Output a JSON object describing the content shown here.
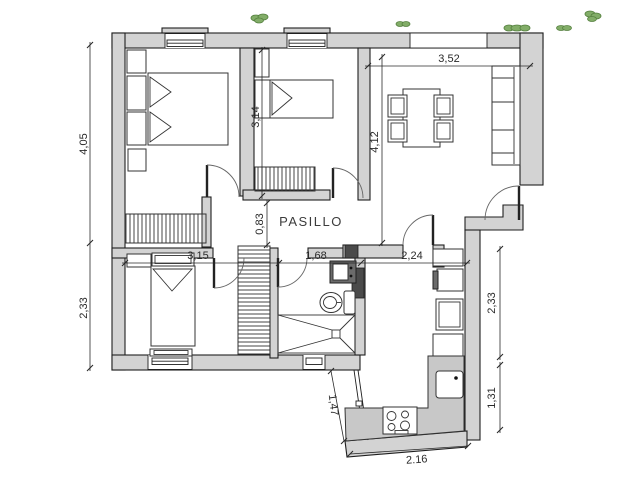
{
  "plan": {
    "hallway_label": "PASILLO",
    "dims": {
      "left_height_top": "4,05",
      "left_height_bottom": "2,33",
      "top_width_living": "3,52",
      "bedroom2_height": "3,14",
      "living_height": "4,12",
      "hallway_width": "0,83",
      "bedroom3_width": "3,15",
      "bathroom_width": "1,68",
      "kitchen_width": "2,24",
      "kitchen_right_upper": "2,33",
      "kitchen_right_lower": "1,31",
      "kitchen_glazing": "1,47",
      "kitchen_bottom": "2.16"
    },
    "colors": {
      "background": "#ffffff",
      "wall": "#d3d3d3",
      "outline": "#1f1f1f",
      "furniture_line": "#333333",
      "counter": "#c8c8c8",
      "fixture_dark": "#6b6b6b",
      "pier": "#4a4a4a",
      "dim": "#2a2a2a",
      "plant": "#82ad68",
      "plant_dark": "#55803f"
    }
  }
}
